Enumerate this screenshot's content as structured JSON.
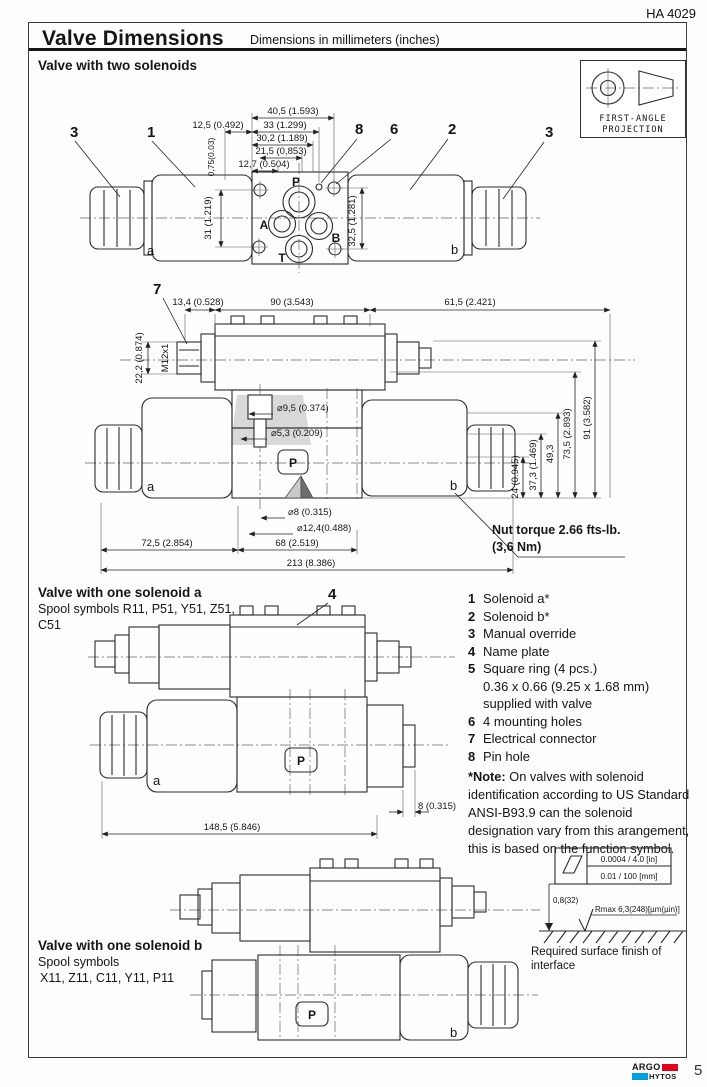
{
  "page": {
    "doc_code": "HA 4029",
    "title": "Valve Dimensions",
    "subtitle": "Dimensions in millimeters (inches)",
    "page_number": "5"
  },
  "projection": {
    "line1": "FIRST-ANGLE",
    "line2": "PROJECTION"
  },
  "headings": {
    "two_solenoids": "Valve with two solenoids",
    "one_solenoid_a": "Valve with one solenoid a",
    "one_solenoid_a_sub1": "Spool symbols R11, P51, Y51, Z51,",
    "one_solenoid_a_sub2": "C51",
    "one_solenoid_b": "Valve with one solenoid b",
    "one_solenoid_b_sub1": "Spool symbols",
    "one_solenoid_b_sub2": "X11, Z11, C11, Y11, P11"
  },
  "d1": {
    "callout_3_left": "3",
    "callout_1": "1",
    "callout_8": "8",
    "callout_6": "6",
    "callout_2": "2",
    "callout_3_right": "3",
    "port_p": "P",
    "port_a": "A",
    "port_b": "B",
    "port_t": "T",
    "side_a": "a",
    "side_b": "b",
    "dim_w405": "40,5 (1.593)",
    "dim_w33": "33 (1.299)",
    "dim_w302": "30,2 (1.189)",
    "dim_w215": "21,5 (0,853)",
    "dim_w127": "12,7 (0.504)",
    "dim_w125": "12,5 (0.492)",
    "dim_h075": "0,75(0.03)",
    "dim_h31": "31 (1.219)",
    "dim_h325": "32,5 (1.281)"
  },
  "d2": {
    "callout_7": "7",
    "side_a": "a",
    "side_b": "b",
    "port_p": "P",
    "dim_w134": "13,4 (0.528)",
    "dim_w90": "90 (3.543)",
    "dim_w615": "61,5 (2.421)",
    "dim_h222": "22,2 (0.874)",
    "thread": "M12x1",
    "dia_95": "⌀9,5 (0.374)",
    "dia_53": "⌀5,3 (0.209)",
    "dia_8": "⌀8 (0.315)",
    "dia_124": "⌀12,4(0.488)",
    "dim_h24": "24 (0.945)",
    "dim_h373": "37,3 (1.469)",
    "dim_h493": "49,3",
    "dim_h735": "73,5 (2.893)",
    "dim_h91": "91 (3.582)",
    "dim_w725": "72,5 (2.854)",
    "dim_w68": "68 (2.519)",
    "dim_w213": "213 (8.386)",
    "nut_line1": "Nut torque 2.66 fts-lb.",
    "nut_line2": "(3,6 Nm)"
  },
  "d3": {
    "callout_4": "4",
    "side_a": "a",
    "port_p": "P",
    "dim_w8": "8 (0.315)",
    "dim_w1485": "148,5 (5.846)"
  },
  "d4": {
    "side_b": "b",
    "port_p": "P"
  },
  "legend": {
    "items": [
      {
        "num": "1",
        "text": "Solenoid a*"
      },
      {
        "num": "2",
        "text": "Solenoid b*"
      },
      {
        "num": "3",
        "text": "Manual override"
      },
      {
        "num": "4",
        "text": "Name plate"
      },
      {
        "num": "5",
        "text": "Square ring (4 pcs.)",
        "cont1": "0.36 x 0.66 (9.25 x 1.68 mm)",
        "cont2": "supplied with valve"
      },
      {
        "num": "6",
        "text": "4 mounting holes"
      },
      {
        "num": "7",
        "text": "Electrical connector"
      },
      {
        "num": "8",
        "text": "Pin hole"
      }
    ],
    "note_prefix": "*Note:",
    "note_text": "On valves with solenoid identification according to US Standard ANSI-B93.9 can the solenoid designation vary from this arangement, this is based on the function symbol."
  },
  "surface_finish": {
    "row_in": "0.0004 / 4.0  [in]",
    "row_mm": "0.01 / 100  [mm]",
    "rough_value": "0,8(32)",
    "rough_rmax": "Rmax 6,3(248)[µm(µin)]",
    "caption1": "Required surface finish of",
    "caption2": "interface"
  },
  "footer": {
    "logo_top": "ARGO",
    "logo_bottom": "HYTOS",
    "page": "5"
  },
  "colors": {
    "accent_red": "#e2001a",
    "accent_blue": "#009fe3",
    "line": "#2b2b2b",
    "shade": "#d9d9d9"
  }
}
